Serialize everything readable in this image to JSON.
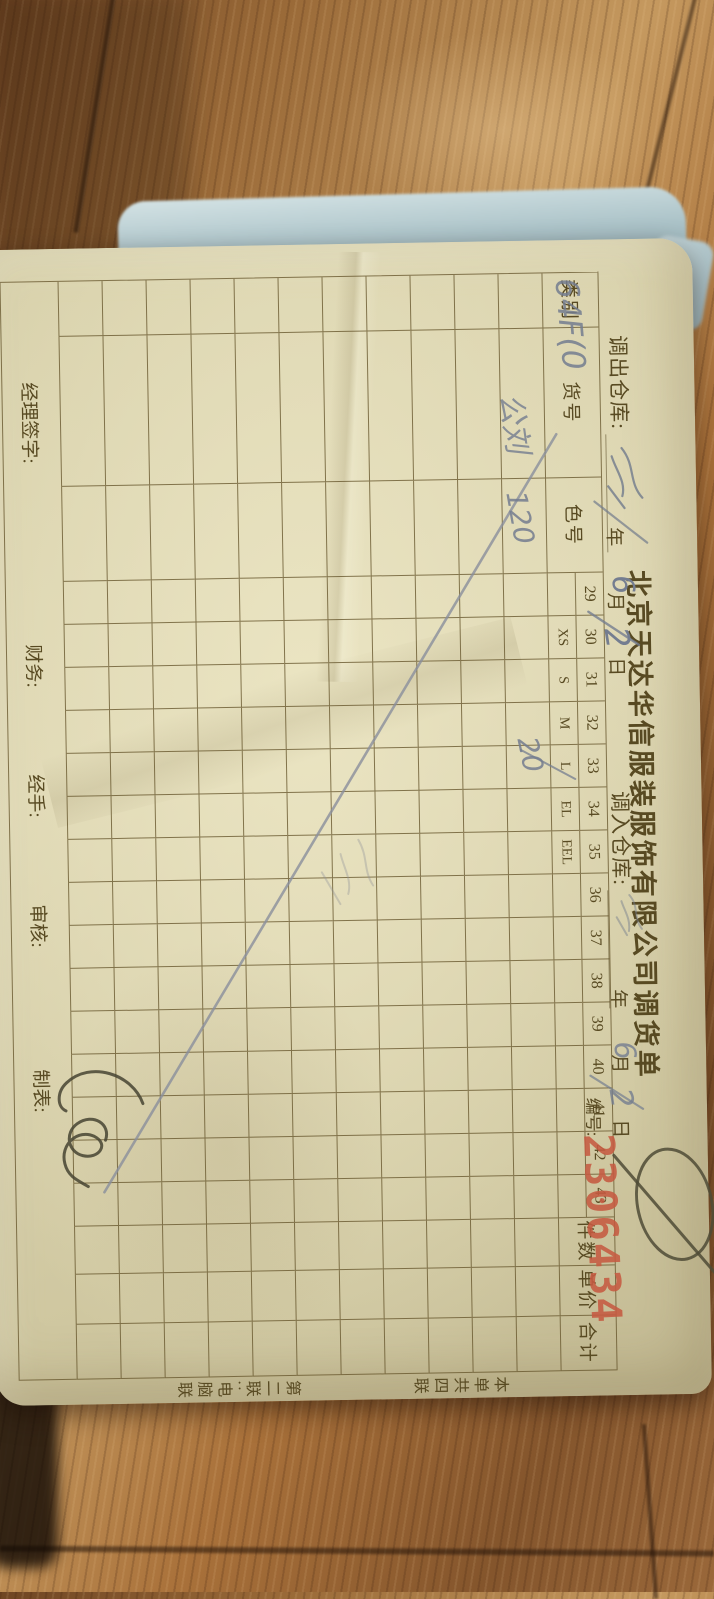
{
  "scene": {
    "description": "Photo of a paper goods-transfer form lying rotated 90 degrees on a wooden table",
    "background": "wood",
    "paper_color": "#d9d2ac",
    "cloth_color": "#b4c9cd",
    "line_color": "#68582e",
    "ink_color": "#747d90",
    "stamp_red": "#c55a41"
  },
  "form": {
    "title": "北京天达华信服装服饰有限公司调货单",
    "out_warehouse_label": "调出仓库:",
    "in_warehouse_label": "调入仓库:",
    "serial_label": "编号:",
    "serial_number": "2306434",
    "date_labels": {
      "year": "年",
      "month": "月",
      "day": "日"
    },
    "columns": [
      "类别",
      "货号",
      "色号",
      "29",
      "30",
      "31",
      "32",
      "33",
      "34",
      "35",
      "36",
      "37",
      "38",
      "39",
      "40",
      "41",
      "42",
      "43",
      "件数",
      "单价",
      "合计"
    ],
    "size_subrow": {
      "30": "XS",
      "31": "S",
      "32": "M",
      "33": "L",
      "34": "EL",
      "35": "EEL"
    },
    "data_row_count": 11,
    "footer_labels": [
      "经理签字:",
      "财务:",
      "经手:",
      "审核:",
      "制表:"
    ],
    "margin_labels": [
      "本单共四联",
      "第二联:电脑联"
    ],
    "handwriting": {
      "item_code": "64F(0",
      "item_code2": "公刘",
      "color_no": "120",
      "qty_size_l": "20",
      "out_month": "6",
      "out_day": "2",
      "in_month": "6",
      "in_day": "2",
      "marks": [
        "long diagonal cancel line across table",
        "circled slash near serial number",
        "signature scrawl near bottom-right of table",
        "faint scribble mid-table",
        "squiggle on 调出仓库 blank",
        "faint squiggle on 调入仓库 blank"
      ]
    }
  }
}
